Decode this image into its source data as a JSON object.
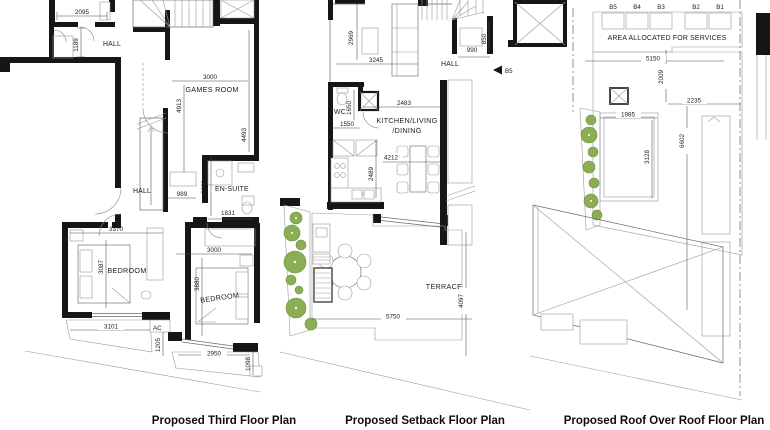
{
  "plans": {
    "third": {
      "caption": "Proposed Third Floor Plan",
      "rooms": {
        "hall_upper": "HALL",
        "games_room": "GAMES ROOM",
        "hall_lower": "HALL",
        "ensuite": "EN-SUITE",
        "bedroom1": "BEDROOM",
        "bedroom2": "BEDROOM",
        "ac": "AC"
      },
      "dims": {
        "d2095": "2095",
        "d1189": "1189",
        "d3000a": "3000",
        "d4913": "4913",
        "d4493": "4493",
        "d989": "989",
        "d2283": "2283",
        "d1831": "1831",
        "d3370": "3370",
        "d3087": "3087",
        "d3000b": "3000",
        "d3880": "3880",
        "d3101": "3101",
        "d1205": "1205",
        "d2950": "2950",
        "d1098": "1098"
      }
    },
    "setback": {
      "caption": "Proposed Setback Floor Plan",
      "rooms": {
        "hall": "HALL",
        "wc": "WC",
        "kitchen_line1": "KITCHEN/LIVING",
        "kitchen_line2": "/DINING",
        "terrace": "TERRACE"
      },
      "marker_b5": "B5",
      "dims": {
        "d2969": "2969",
        "d3245": "3245",
        "d990": "990",
        "d850": "850",
        "d1650": "1650",
        "d1550": "1550",
        "d2483": "2483",
        "d4212": "4212",
        "d2489": "2489",
        "d5750": "5750",
        "d4097": "4097"
      }
    },
    "roof": {
      "caption": "Proposed Roof Over Roof Floor Plan",
      "labels": {
        "services": "AREA ALLOCATED FOR SERVICES",
        "b5": "B5",
        "b4": "B4",
        "b3": "B3",
        "b2": "B2",
        "b1": "B1"
      },
      "dims": {
        "d5150": "5150",
        "d2009": "2009",
        "d2235": "2235",
        "d1985": "1985",
        "d3128": "3128",
        "d6602": "6602"
      }
    }
  },
  "colors": {
    "wall": "#161616",
    "hatch": "#c8c8c8",
    "plant_green": "#8bae54"
  }
}
